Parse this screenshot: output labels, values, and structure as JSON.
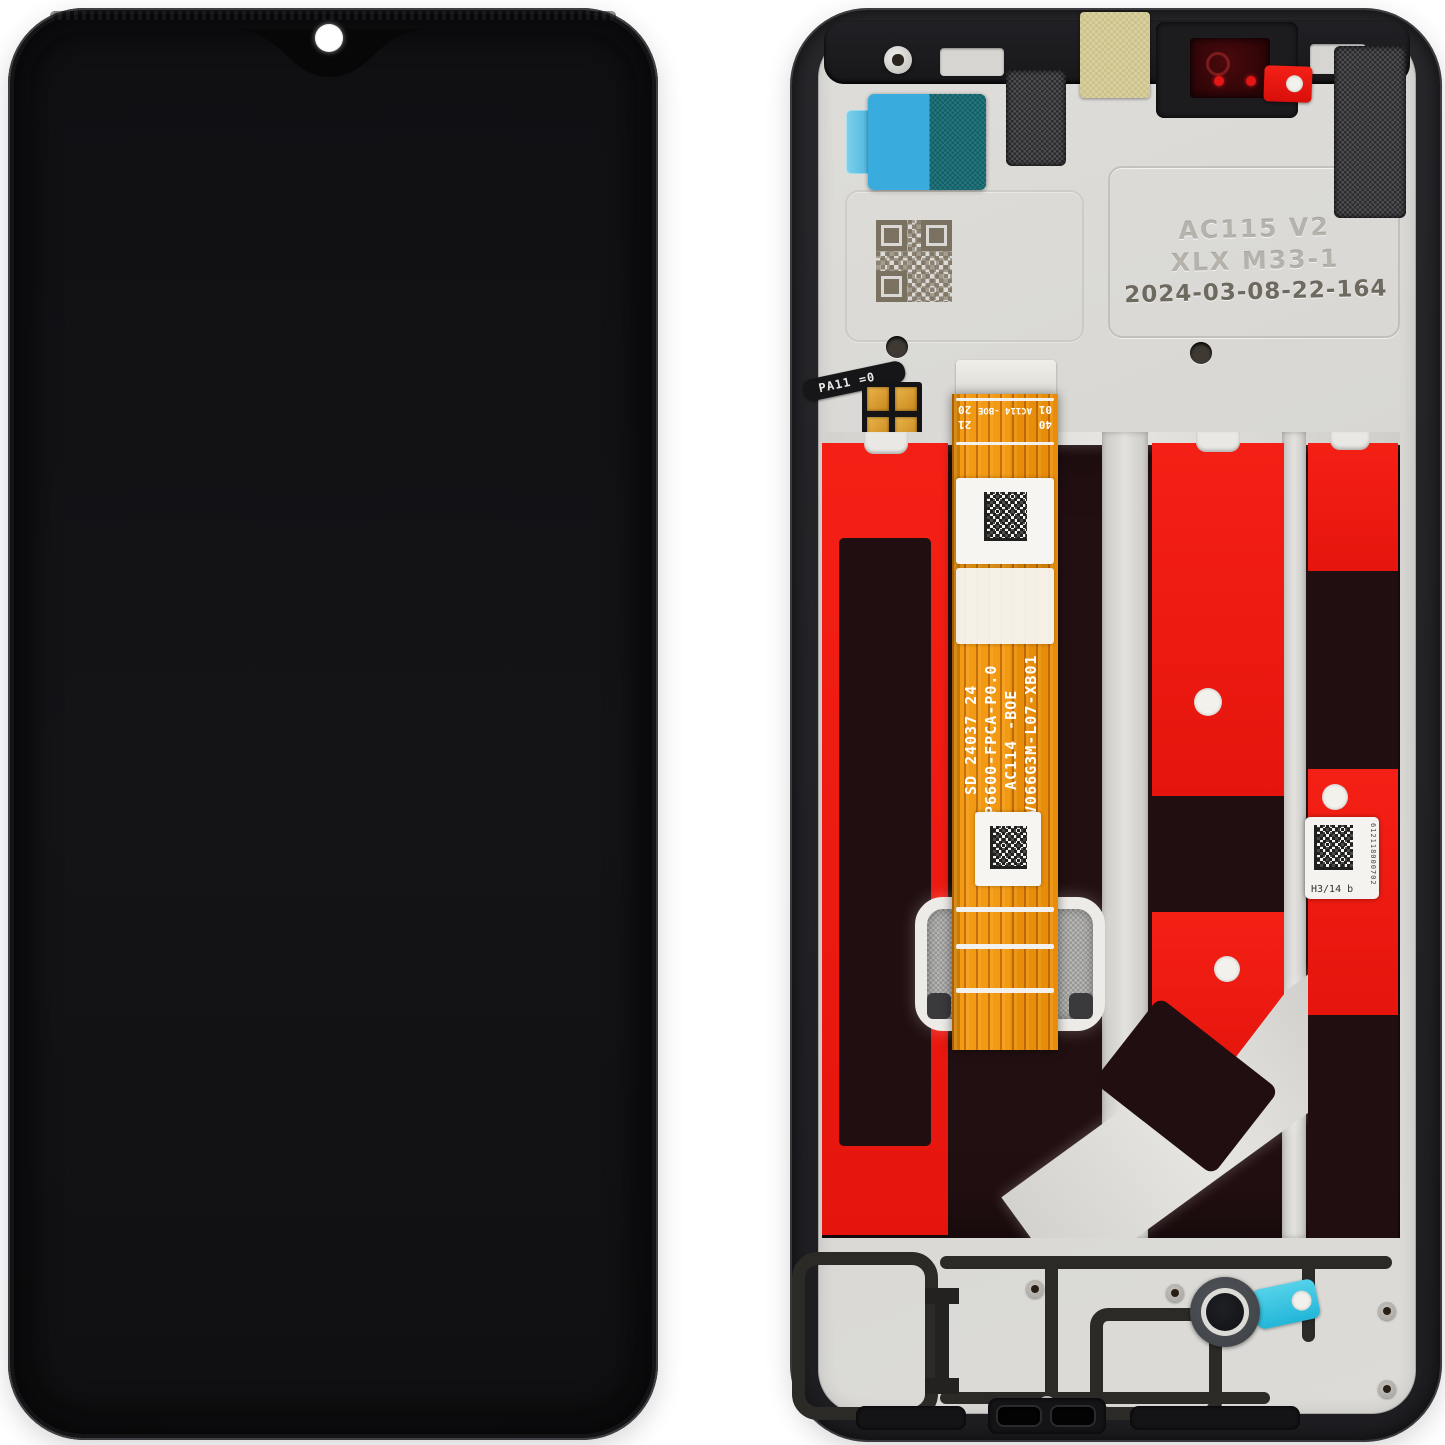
{
  "meta": {
    "description": "Smartphone LCD display assembly with frame, front view and internal back view, on white background",
    "background": "#ffffff"
  },
  "front": {
    "camera_dot_color": "#ffffff"
  },
  "back": {
    "markings": {
      "line1": "AC115 V2",
      "line2": "XLX M33-1",
      "line3": "2024-03-08-22-164"
    },
    "connector": {
      "label": "AC114 -BOE",
      "p01": "01",
      "p20": "20",
      "p21": "21",
      "p40": "40"
    },
    "flex_text": {
      "l1": "SD 24037 24",
      "l2": "P6600-FPCA-P0.0",
      "l3": "AC114 -BOE",
      "l4": "BV066G3M-L07-XB01"
    },
    "sensor_flex": {
      "label": "PA11 =0"
    },
    "serial_label": {
      "code": "H3/14 b",
      "serial": "612118000702"
    },
    "colors": {
      "adhesive_red": "#ee1c12",
      "flex_orange": "#ef9410",
      "sticker_blue": "#39abdc",
      "sticker_teal": "#0e6069",
      "sticker_yellow": "#d8cf9c",
      "pull_tab_red": "#ee1414",
      "tab_cyan": "#2bc3e3",
      "plate_silver": "#d9d8d4",
      "frame_black": "#232327",
      "panel_dark": "#220f11"
    }
  }
}
